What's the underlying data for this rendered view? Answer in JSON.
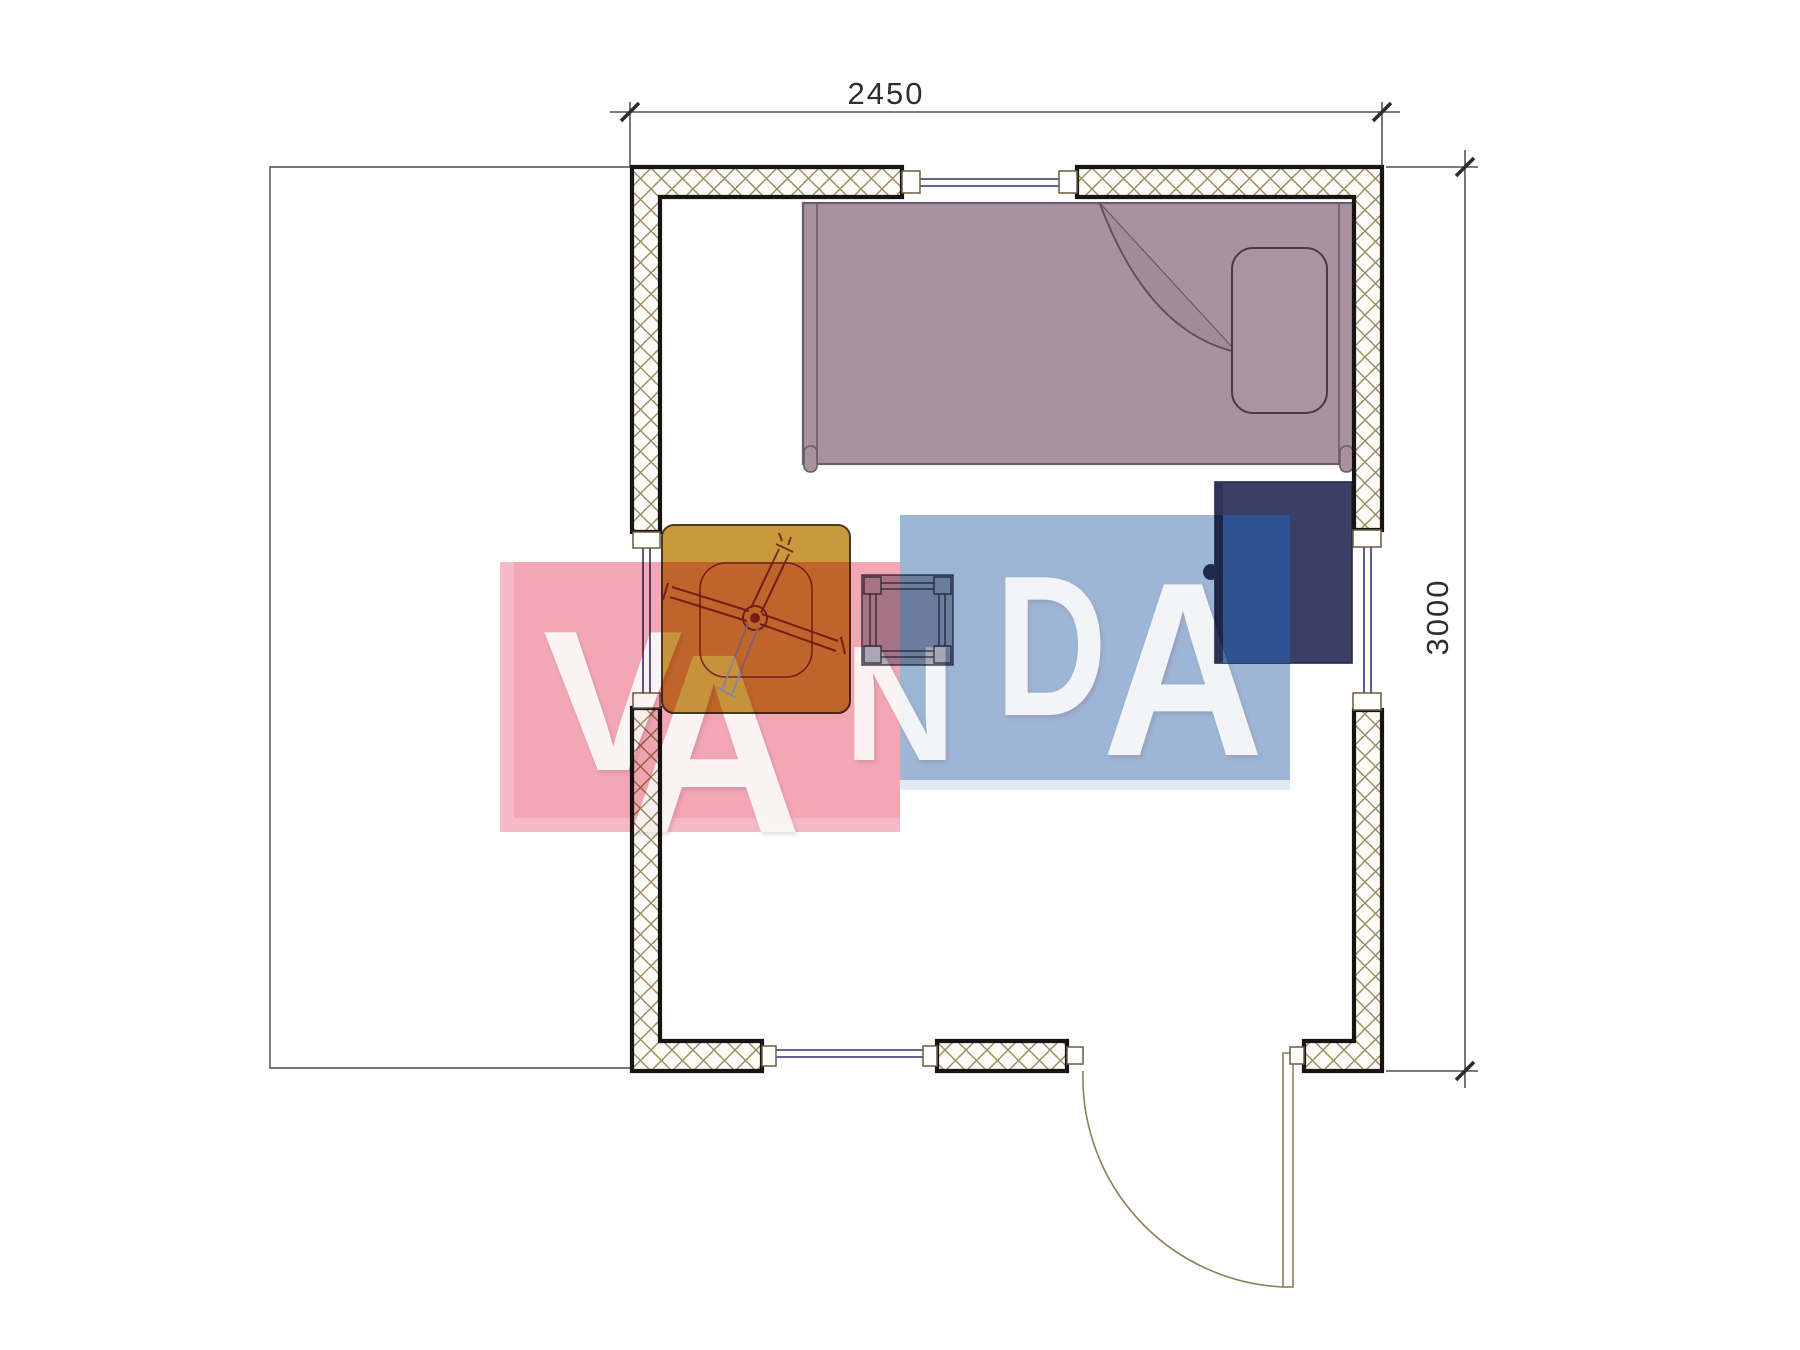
{
  "page": {
    "title": "Cabin floor plan with VANDA watermark"
  },
  "dimensions": {
    "width_label": "2450",
    "height_label": "3000"
  },
  "watermark": {
    "word": "VANDA",
    "letters": [
      "V",
      "A",
      "N",
      "D",
      "A"
    ],
    "pink_color": "#f3a7b5",
    "blue_color": "#9db6d6",
    "letter_color": "#ffffff"
  },
  "colors": {
    "wall_outline": "#171513",
    "wall_hatch": "#9a8a5c",
    "window_line": "#2f3070",
    "bed": "#a9919f",
    "bed_outline": "#6a5c68",
    "wardrobe": "#3a4065",
    "wardrobe_lit": "#4e73ad",
    "table": "#c99a3d",
    "fan_line": "#7c2b20",
    "stool": "#aeafbc",
    "door_line": "#8f7f56",
    "dimension_line": "#2d2d2d"
  },
  "furniture": [
    {
      "name": "single-bed"
    },
    {
      "name": "pillow"
    },
    {
      "name": "folded-blanket-corner"
    },
    {
      "name": "wardrobe"
    },
    {
      "name": "table-with-ceiling-fan"
    },
    {
      "name": "stool"
    },
    {
      "name": "entry-door"
    }
  ]
}
